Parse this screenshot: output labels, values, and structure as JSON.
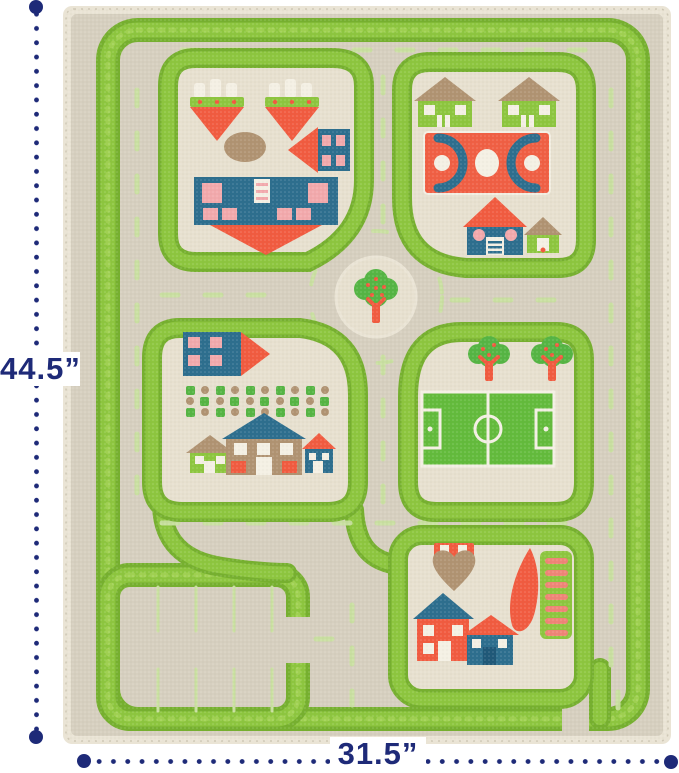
{
  "annotations": {
    "height_label": "44.5”",
    "width_label": "31.5”"
  },
  "palette": {
    "navy": "#1e2a78",
    "rugBase": "#d6cfbf",
    "rugEdge": "#eae4d5",
    "blockFill": "#e7e0cf",
    "dashGreen": "#c9e0a0",
    "green": "#8dc63f",
    "greenDark": "#76b02f",
    "greenLight": "#abd75c",
    "red": "#f15b40",
    "teal": "#2d6e8e",
    "tealDark": "#1f5878",
    "pink": "#f2a9ac",
    "salmon": "#ef8577",
    "brown": "#b09372",
    "treeGreen": "#55b544",
    "fieldGreen": "#63bb3c",
    "white": "#f4f0e4",
    "lineCream": "#cfc8b6"
  },
  "rug": {
    "type": "kids-3d-play-carpet-traffic-rug",
    "features": [
      "outer-grass-road-border",
      "residential-block-top-left",
      "block-top-right-with-basketball-court",
      "roundabout-with-tree",
      "residential-block-middle-left-with-garden",
      "block-middle-right-with-soccer-field-and-trees",
      "block-bottom-right-with-playground-and-houses",
      "parking-lot-bottom-left",
      "dashed-lane-markings"
    ]
  }
}
